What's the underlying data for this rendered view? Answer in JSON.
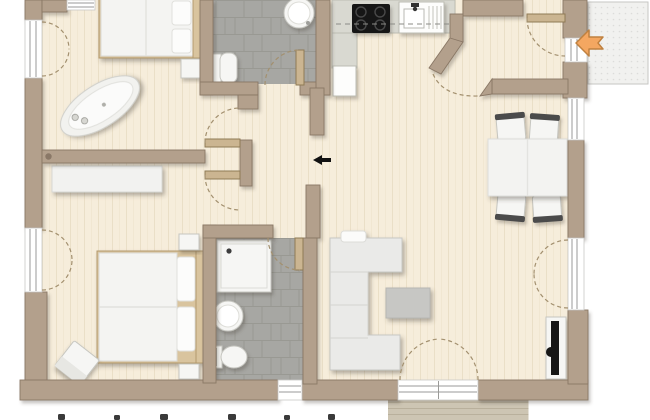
{
  "plan": {
    "type": "apartment-floor-plan",
    "orientation_note": "plan cropped at top and bottom edges",
    "indicators": {
      "entry_arrow": {
        "icon": "entrance-arrow",
        "direction": "left"
      },
      "passage_arrow": {
        "icon": "passage-arrow",
        "direction": "left"
      }
    },
    "rooms": [
      {
        "id": "bedroom-1",
        "floor": "wood",
        "furniture": [
          "double-bed",
          "pillows",
          "nightstand",
          "freestanding-bathtub"
        ]
      },
      {
        "id": "bathroom-1",
        "floor": "gray-tile",
        "furniture": [
          "toilet",
          "round-sink"
        ]
      },
      {
        "id": "kitchen",
        "floor": "wood",
        "furniture": [
          "l-shaped-counter",
          "cooktop-4-burners",
          "kitchen-sink-with-drainer",
          "fridge",
          "overhead-cabinets-dashed"
        ]
      },
      {
        "id": "entry-vestibule",
        "floor": "wood",
        "furniture": []
      },
      {
        "id": "dining-living",
        "floor": "wood",
        "furniture": [
          "dining-table",
          "chair",
          "chair",
          "chair",
          "chair",
          "corner-sofa",
          "coffee-table",
          "tv-on-wall-panel"
        ]
      },
      {
        "id": "hallway",
        "floor": "wood",
        "furniture": []
      },
      {
        "id": "bedroom-2",
        "floor": "wood",
        "furniture": [
          "double-bed",
          "pillows",
          "nightstand",
          "nightstand",
          "wardrobe",
          "stool"
        ]
      },
      {
        "id": "bathroom-2",
        "floor": "gray-tile",
        "furniture": [
          "shower",
          "round-sink",
          "toilet"
        ]
      }
    ],
    "outdoor": [
      "entry-platform-top-right",
      "wood-deck-bottom"
    ],
    "openings": {
      "windows": 4,
      "french_doors": 3,
      "interior_doors": 5,
      "entry_doors": 1,
      "wall_passages": 1
    },
    "cutoff_text_marks_x": [
      58,
      114,
      160,
      228,
      284,
      328
    ]
  },
  "colors": {
    "bg": "#ffffff",
    "wall": "#b3a08c",
    "wall_edge": "#897765",
    "floor": "#f6eddb",
    "floor_line": "#eadfc7",
    "tile": "#a7a7a3",
    "tile_line": "#96968f",
    "fixture": "#f6f6f4",
    "fixture_edge": "#c6c6c0",
    "counter": "#d9d9d1",
    "counter_edge": "#bdbdb3",
    "appliance": "#fdfdfc",
    "cooktop": "#161616",
    "burner": "#484848",
    "door_leaf": "#cbb591",
    "door_leaf_edge": "#8f7a55",
    "arc": "#a3906f",
    "glass": "#9a9a98",
    "sofa": "#eaeae8",
    "sofa_edge": "#c8c8c4",
    "table": "#f3f3f1",
    "chair_rail": "#4b4b4b",
    "coffee_table": "#c7c7c4",
    "tv": "#141414",
    "bed_frame": "#d9c49e",
    "bed_frame_edge": "#b49a6d",
    "arrow_fill": "#f4a761",
    "arrow_edge": "#bf8140",
    "deck": "#cdc5b3",
    "deck_line": "#b9b09c",
    "platform": "#f1f1ef",
    "platform_edge": "#c6c6c3",
    "mark": "#3a3a3a"
  }
}
